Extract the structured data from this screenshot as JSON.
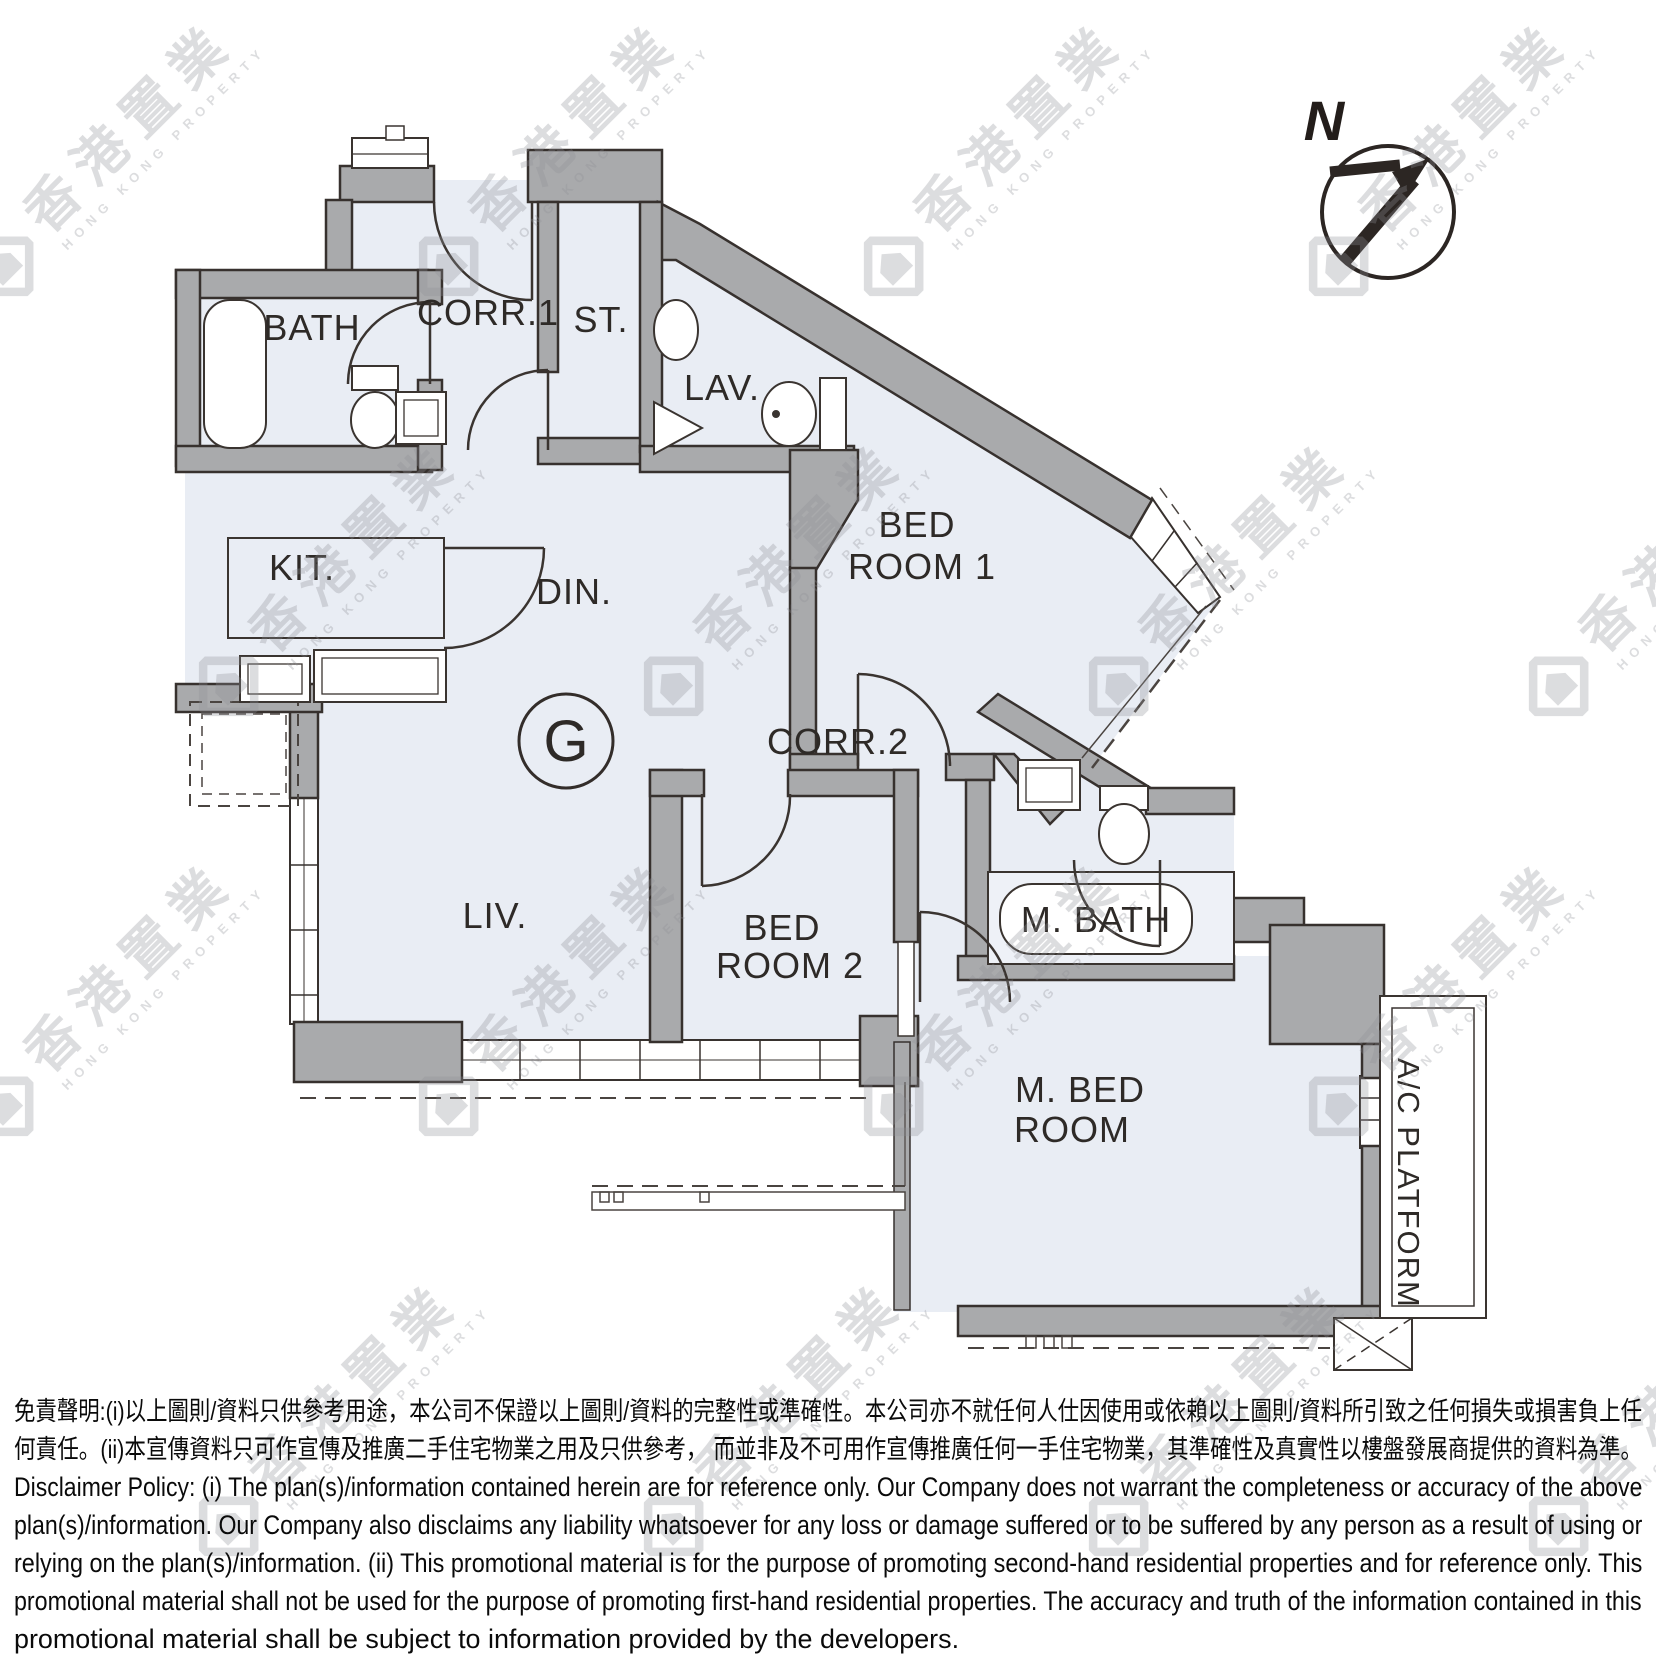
{
  "compass": {
    "north_label": "N"
  },
  "unit": {
    "label": "G"
  },
  "rooms": {
    "bath": {
      "label": "BATH"
    },
    "corr1": {
      "label": "CORR.1"
    },
    "st": {
      "label": "ST."
    },
    "lav": {
      "label": "LAV."
    },
    "kit": {
      "label": "KIT."
    },
    "din": {
      "label": "DIN."
    },
    "bedroom1": {
      "lines": [
        "BED",
        "ROOM 1"
      ]
    },
    "corr2": {
      "label": "CORR.2"
    },
    "liv": {
      "label": "LIV."
    },
    "bedroom2": {
      "lines": [
        "BED",
        "ROOM 2"
      ]
    },
    "mbath": {
      "label": "M. BATH"
    },
    "mbedroom": {
      "lines": [
        "M. BED",
        "ROOM"
      ]
    },
    "ac_platform": {
      "label": "A/C PLATFORM"
    }
  },
  "watermark": {
    "chinese": "香港置業",
    "english": "HONG KONG PROPERTY"
  },
  "disclaimer": {
    "lines": [
      "免責聲明:(i)以上圖則/資料只供參考用途，本公司不保證以上圖則/資料的完整性或準確性。本公司亦不就任何人仕因使用或依賴以上圖則/資料所引致之任何損失或損害負上任",
      "何責任。(ii)本宣傳資料只可作宣傳及推廣二手住宅物業之用及只供參考， 而並非及不可用作宣傳推廣任何一手住宅物業，其準確性及真實性以樓盤發展商提供的資料為準。",
      "Disclaimer Policy: (i) The plan(s)/information contained herein are for reference only. Our Company does not warrant the completeness or accuracy of the above",
      "plan(s)/information. Our Company also disclaims any liability whatsoever for any loss or damage suffered or to be suffered by any person as a result of using or",
      "relying on the plan(s)/information. (ii) This promotional material is for the purpose of promoting second-hand residential properties and for reference only. This",
      "promotional material shall not be used for the purpose of promoting first-hand residential properties. The accuracy and truth of the information contained in this",
      "promotional material shall be subject to information provided by the developers."
    ]
  }
}
